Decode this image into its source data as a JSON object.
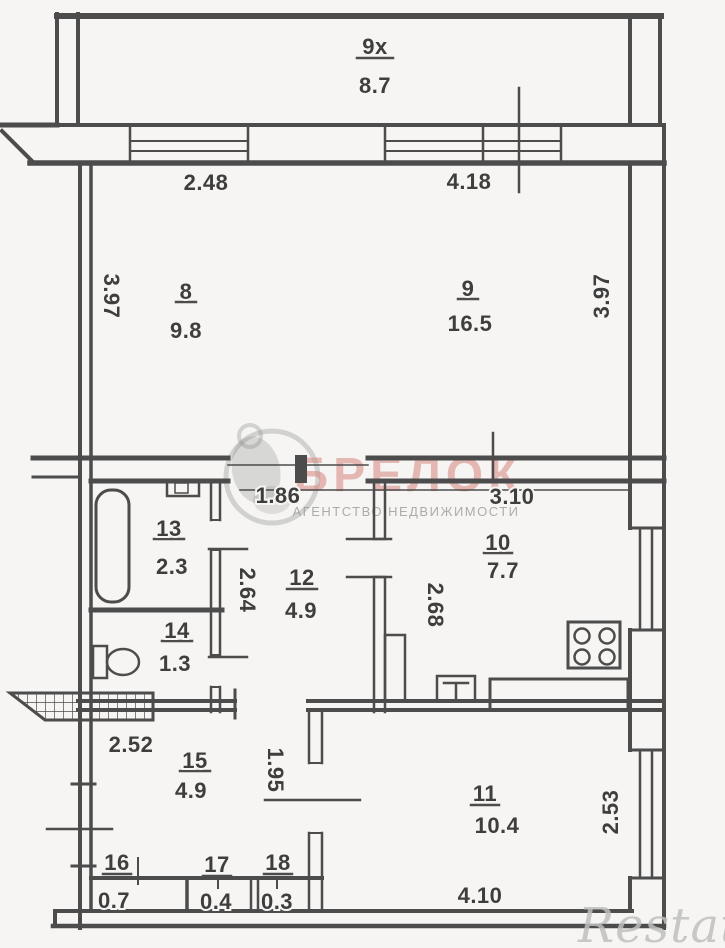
{
  "meta": {
    "type": "apartment floor plan (scanned)"
  },
  "palette": {
    "background": "#f6f5f3",
    "line": "#4c4c4c",
    "text": "#3e3e3e",
    "watermark_red": "#d98c84",
    "watermark_gray": "#bfbfbf"
  },
  "balcony": {
    "number": "9x",
    "area": "8.7"
  },
  "rooms": [
    {
      "number": "8",
      "area": "9.8"
    },
    {
      "number": "9",
      "area": "16.5"
    },
    {
      "number": "10",
      "area": "7.7"
    },
    {
      "number": "11",
      "area": "10.4"
    },
    {
      "number": "12",
      "area": "4.9"
    },
    {
      "number": "13",
      "area": "2.3"
    },
    {
      "number": "14",
      "area": "1.3"
    },
    {
      "number": "15",
      "area": "4.9"
    },
    {
      "number": "16",
      "area": "0.7"
    },
    {
      "number": "17",
      "area": "0.4"
    },
    {
      "number": "18",
      "area": "0.3"
    }
  ],
  "dimensions": {
    "room8_width": "2.48",
    "room9_width": "4.18",
    "left_height": "3.97",
    "right_height": "3.97",
    "hall_width": "1.86",
    "kitchen_width": "3.10",
    "hall_depth": "2.64",
    "kitchen_depth": "2.68",
    "entry_width": "2.52",
    "room15_depth": "1.95",
    "room11_depth": "2.53",
    "room11_width": "4.10"
  },
  "watermarks": {
    "agency": {
      "name": "БРЕЛОК",
      "tagline": "АГЕНТСТВО НЕДВИЖИМОСТИ"
    },
    "portal": {
      "name": "Restate"
    }
  },
  "fixtures": [
    "bathtub-icon",
    "wash-sink-icon",
    "toilet-icon",
    "stove-icon",
    "kitchen-sink-icon",
    "kitchen-counter-icon",
    "vent-shaft-icon",
    "window-icon",
    "entry-stairs-icon"
  ]
}
